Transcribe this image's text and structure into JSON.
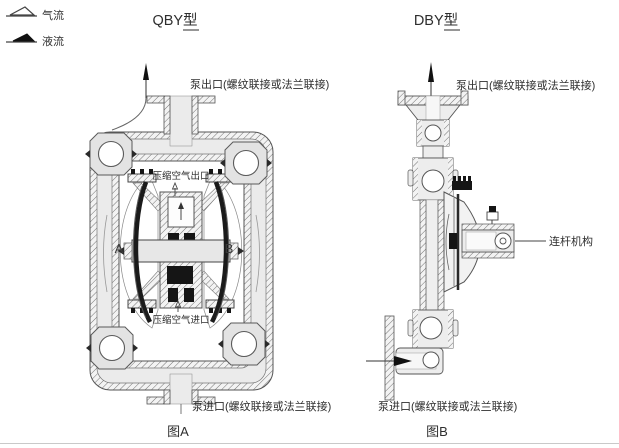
{
  "legend": {
    "air_label": "气流",
    "liquid_label": "液流"
  },
  "qby": {
    "title": "QBY型",
    "outlet_label": "泵出口(螺纹联接或法兰联接)",
    "compressed_air_outlet_label": "压缩空气出口",
    "compressed_air_inlet_label": "压缩空气进口",
    "chamber_a_label": "A",
    "chamber_b_label": "B",
    "inlet_label": "泵进口(螺纹联接或法兰联接)",
    "caption": "图A"
  },
  "dby": {
    "title": "DBY型",
    "outlet_label": "泵出口(螺纹联接或法兰联接)",
    "linkage_label": "连杆机构",
    "inlet_label": "泵进口(螺纹联接或法兰联接)",
    "caption": "图B"
  },
  "colors": {
    "line": "#4a4a4a",
    "body_fill": "#ebebeb",
    "diaphragm": "#1b1b1b",
    "background": "#ffffff",
    "bottom_rule": "#c9c9c9"
  }
}
